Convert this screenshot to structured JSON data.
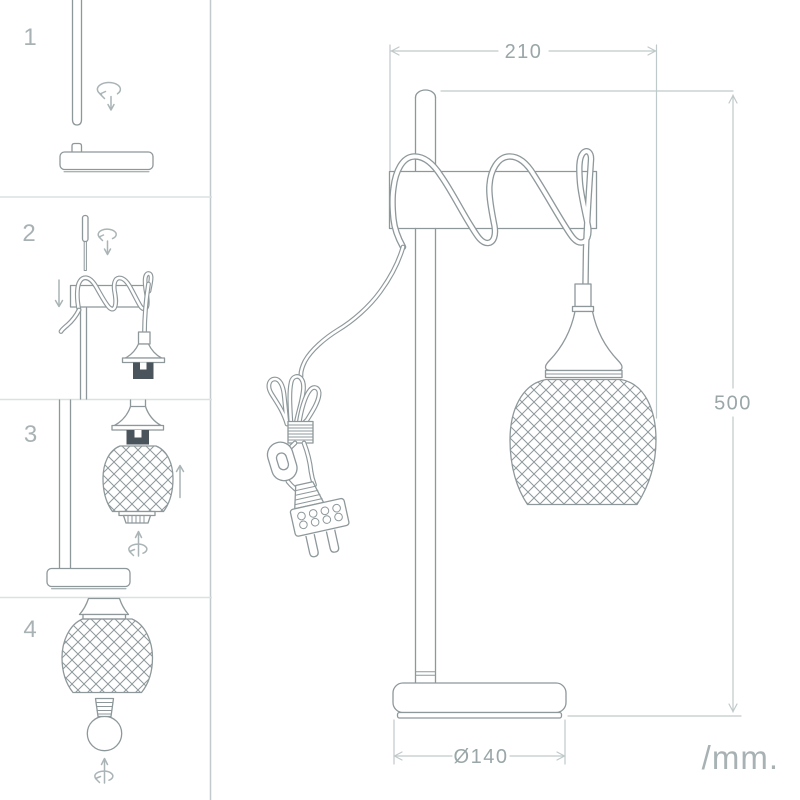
{
  "canvas": {
    "width": 800,
    "height": 800
  },
  "colors": {
    "background": "#ffffff",
    "line": "#8e989b",
    "line_light": "#aab4b6",
    "dimension": "#c0c9ca",
    "text": "#9aa6a8",
    "text_light": "#a8b2b4",
    "step_number": "#a8b2b4",
    "dark_fill": "#49545c",
    "border_v": "#c2cacc",
    "border_h": "#dbe0e0"
  },
  "steps": [
    {
      "number": "1"
    },
    {
      "number": "2"
    },
    {
      "number": "3"
    },
    {
      "number": "4"
    }
  ],
  "dimensions": {
    "width_label": "210",
    "height_label": "500",
    "base_diameter_label": "Ø140"
  },
  "footer": {
    "units_label": "/mm."
  },
  "icon_names": [
    "rotation-arrow-icon",
    "down-arrow-icon",
    "up-arrow-icon"
  ]
}
